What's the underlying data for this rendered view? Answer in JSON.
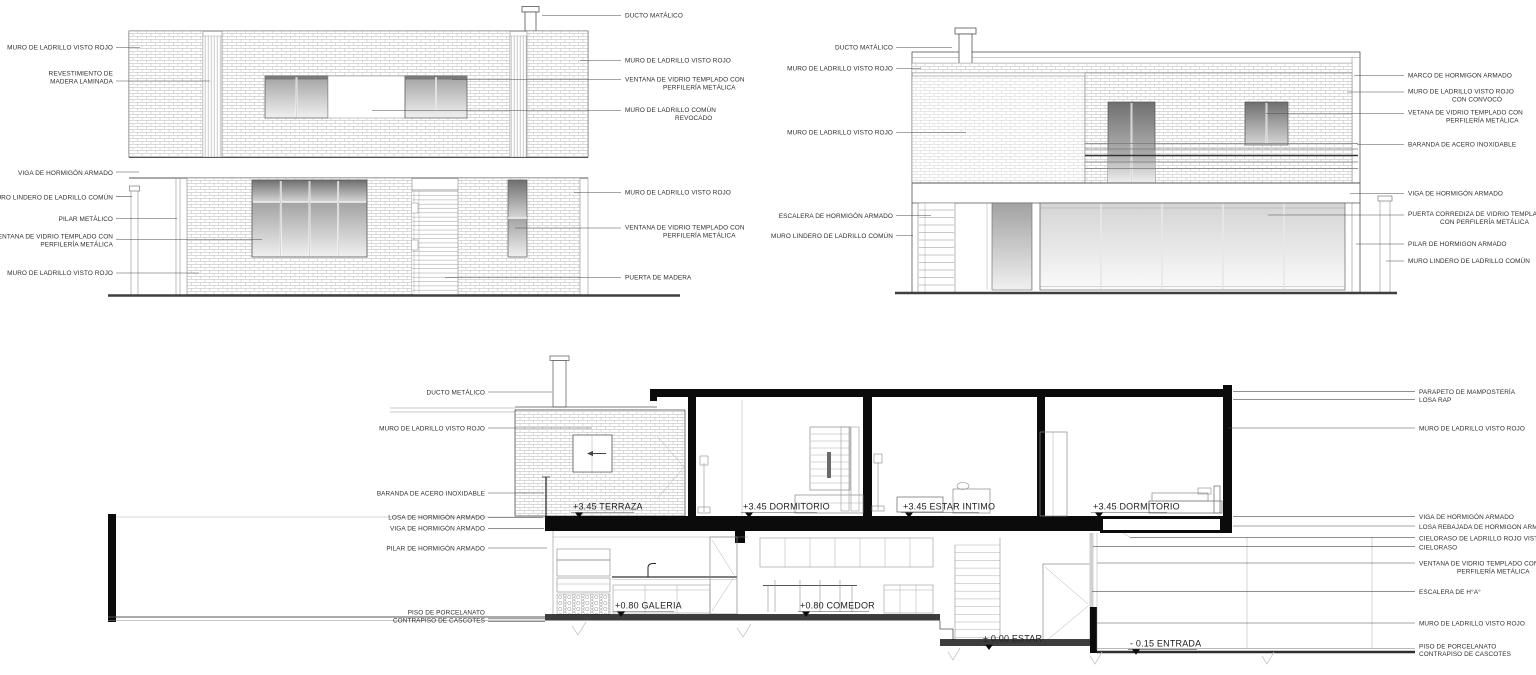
{
  "drawing": {
    "title_hint": "Architectural elevations and section drawing",
    "colors": {
      "line": "#4c4c4c",
      "brick_joint": "#c5c5c5",
      "cut_fill": "#0b0b0b",
      "glass_top": "#6f6f6f",
      "glass_bottom": "#f0f0f0",
      "ground": "#3f3f3f"
    },
    "e1": {
      "left": [
        {
          "l1": "MURO DE LADRILLO VISTO ROJO"
        },
        {
          "l1": "REVESTIMIENTO DE",
          "l2": "MADERA LAMINADA"
        },
        {
          "l1": "VIGA DE HORMIGÓN ARMADO"
        },
        {
          "l1": "MURO LINDERO DE LADRILLO COMÚN"
        },
        {
          "l1": "PILAR METÁLICO"
        },
        {
          "l1": "VENTANA DE VIDRIO TEMPLADO CON",
          "l2": "PERFILERÍA METÁLICA"
        },
        {
          "l1": "MURO DE LADRILLO VISTO ROJO"
        }
      ],
      "right": [
        {
          "l1": "DUCTO MATÁLICO"
        },
        {
          "l1": "MURO DE LADRILLO VISTO ROJO"
        },
        {
          "l1": "VENTANA DE VIDRIO TEMPLADO CON",
          "l2": "PERFILERÍA METÁLICA"
        },
        {
          "l1": "MURO DE LADRILLO COMÚN",
          "l2": "REVOCADO"
        },
        {
          "l1": "MURO DE LADRILLO VISTO ROJO"
        },
        {
          "l1": "VENTANA DE VIDRIO TEMPLADO CON",
          "l2": "PERFILERÍA METÁLICA"
        },
        {
          "l1": "PUERTA DE MADERA"
        }
      ]
    },
    "e2": {
      "left": [
        {
          "l1": "DUCTO MATÁLICO"
        },
        {
          "l1": "MURO DE LADRILLO VISTO ROJO"
        },
        {
          "l1": "MURO DE LADRILLO VISTO ROJO"
        },
        {
          "l1": "ESCALERA DE HORMIGÓN ARMADO"
        },
        {
          "l1": "MURO LINDERO DE LADRILLO COMÚN"
        }
      ],
      "right": [
        {
          "l1": "MARCO DE HORMIGON ARMADO"
        },
        {
          "l1": "MURO DE LADRILLO VISTO ROJO",
          "l2": "CON CONVOCÓ"
        },
        {
          "l1": "VETANA DE VIDRIO  TEMPLADO CON",
          "l2": "PERFILERÍA METÁLICA"
        },
        {
          "l1": "BARANDA DE ACERO INOXIDABLE"
        },
        {
          "l1": "VIGA DE HORMIGÓN ARMADO"
        },
        {
          "l1": "PUERTA CORREDIZA DE VIDRIO  TEMPLADO",
          "l2": "CON PERFILERÍA METÁLICA"
        },
        {
          "l1": "PILAR DE HORMIGON ARMADO"
        },
        {
          "l1": "MURO LINDERO DE LADRILLO COMÚN"
        }
      ]
    },
    "sec": {
      "left": [
        {
          "l1": "DUCTO METÁLICO"
        },
        {
          "l1": "MURO DE LADRILLO VISTO ROJO"
        },
        {
          "l1": "BARANDA DE ACERO INOXIDABLE"
        },
        {
          "l1": "LOSA DE HORMIGÓN ARMADO"
        },
        {
          "l1": "VIGA DE HORMIGÓN ARMADO"
        },
        {
          "l1": "PILAR DE HORMIGÓN ARMADO"
        },
        {
          "l1": "PISO DE PORCELANATO",
          "l2": "CONTRAPISO DE CASCOTES"
        }
      ],
      "right": [
        {
          "l1": "PARAPETO DE MAMPOSTERÍA"
        },
        {
          "l1": "LOSA RAP"
        },
        {
          "l1": "MURO DE LADRILLO VISTO ROJO"
        },
        {
          "l1": "VIGA DE HORMIGÓN ARMADO"
        },
        {
          "l1": "LOSA REBAJADA DE HORMIGON ARMADO"
        },
        {
          "l1": "CIELORASO DE LADRILLO ROJO VISTO"
        },
        {
          "l1": "CIELORASO"
        },
        {
          "l1": "VENTANA DE VIDRIO TEMPLADO CON",
          "l2": "PERFILERÍA METÁLICA"
        },
        {
          "l1": "ESCALERA DE H°A°"
        },
        {
          "l1": "MURO DE LADRILLO VISTO ROJO"
        },
        {
          "l1": "PISO DE PORCELANATO",
          "l2": "CONTRAPISO DE CASCOTES"
        }
      ],
      "levels": [
        {
          "text": "+3.45 TERRAZA"
        },
        {
          "text": "+3.45 DORMITORIO"
        },
        {
          "text": "+3.45 ESTAR INTIMO"
        },
        {
          "text": "+3.45 DORMITORIO"
        },
        {
          "text": "+0.80 GALERIA"
        },
        {
          "text": "+0.80 COMEDOR"
        },
        {
          "text": "± 0.00 ESTAR"
        },
        {
          "text": "- 0.15 ENTRADA"
        }
      ]
    }
  }
}
